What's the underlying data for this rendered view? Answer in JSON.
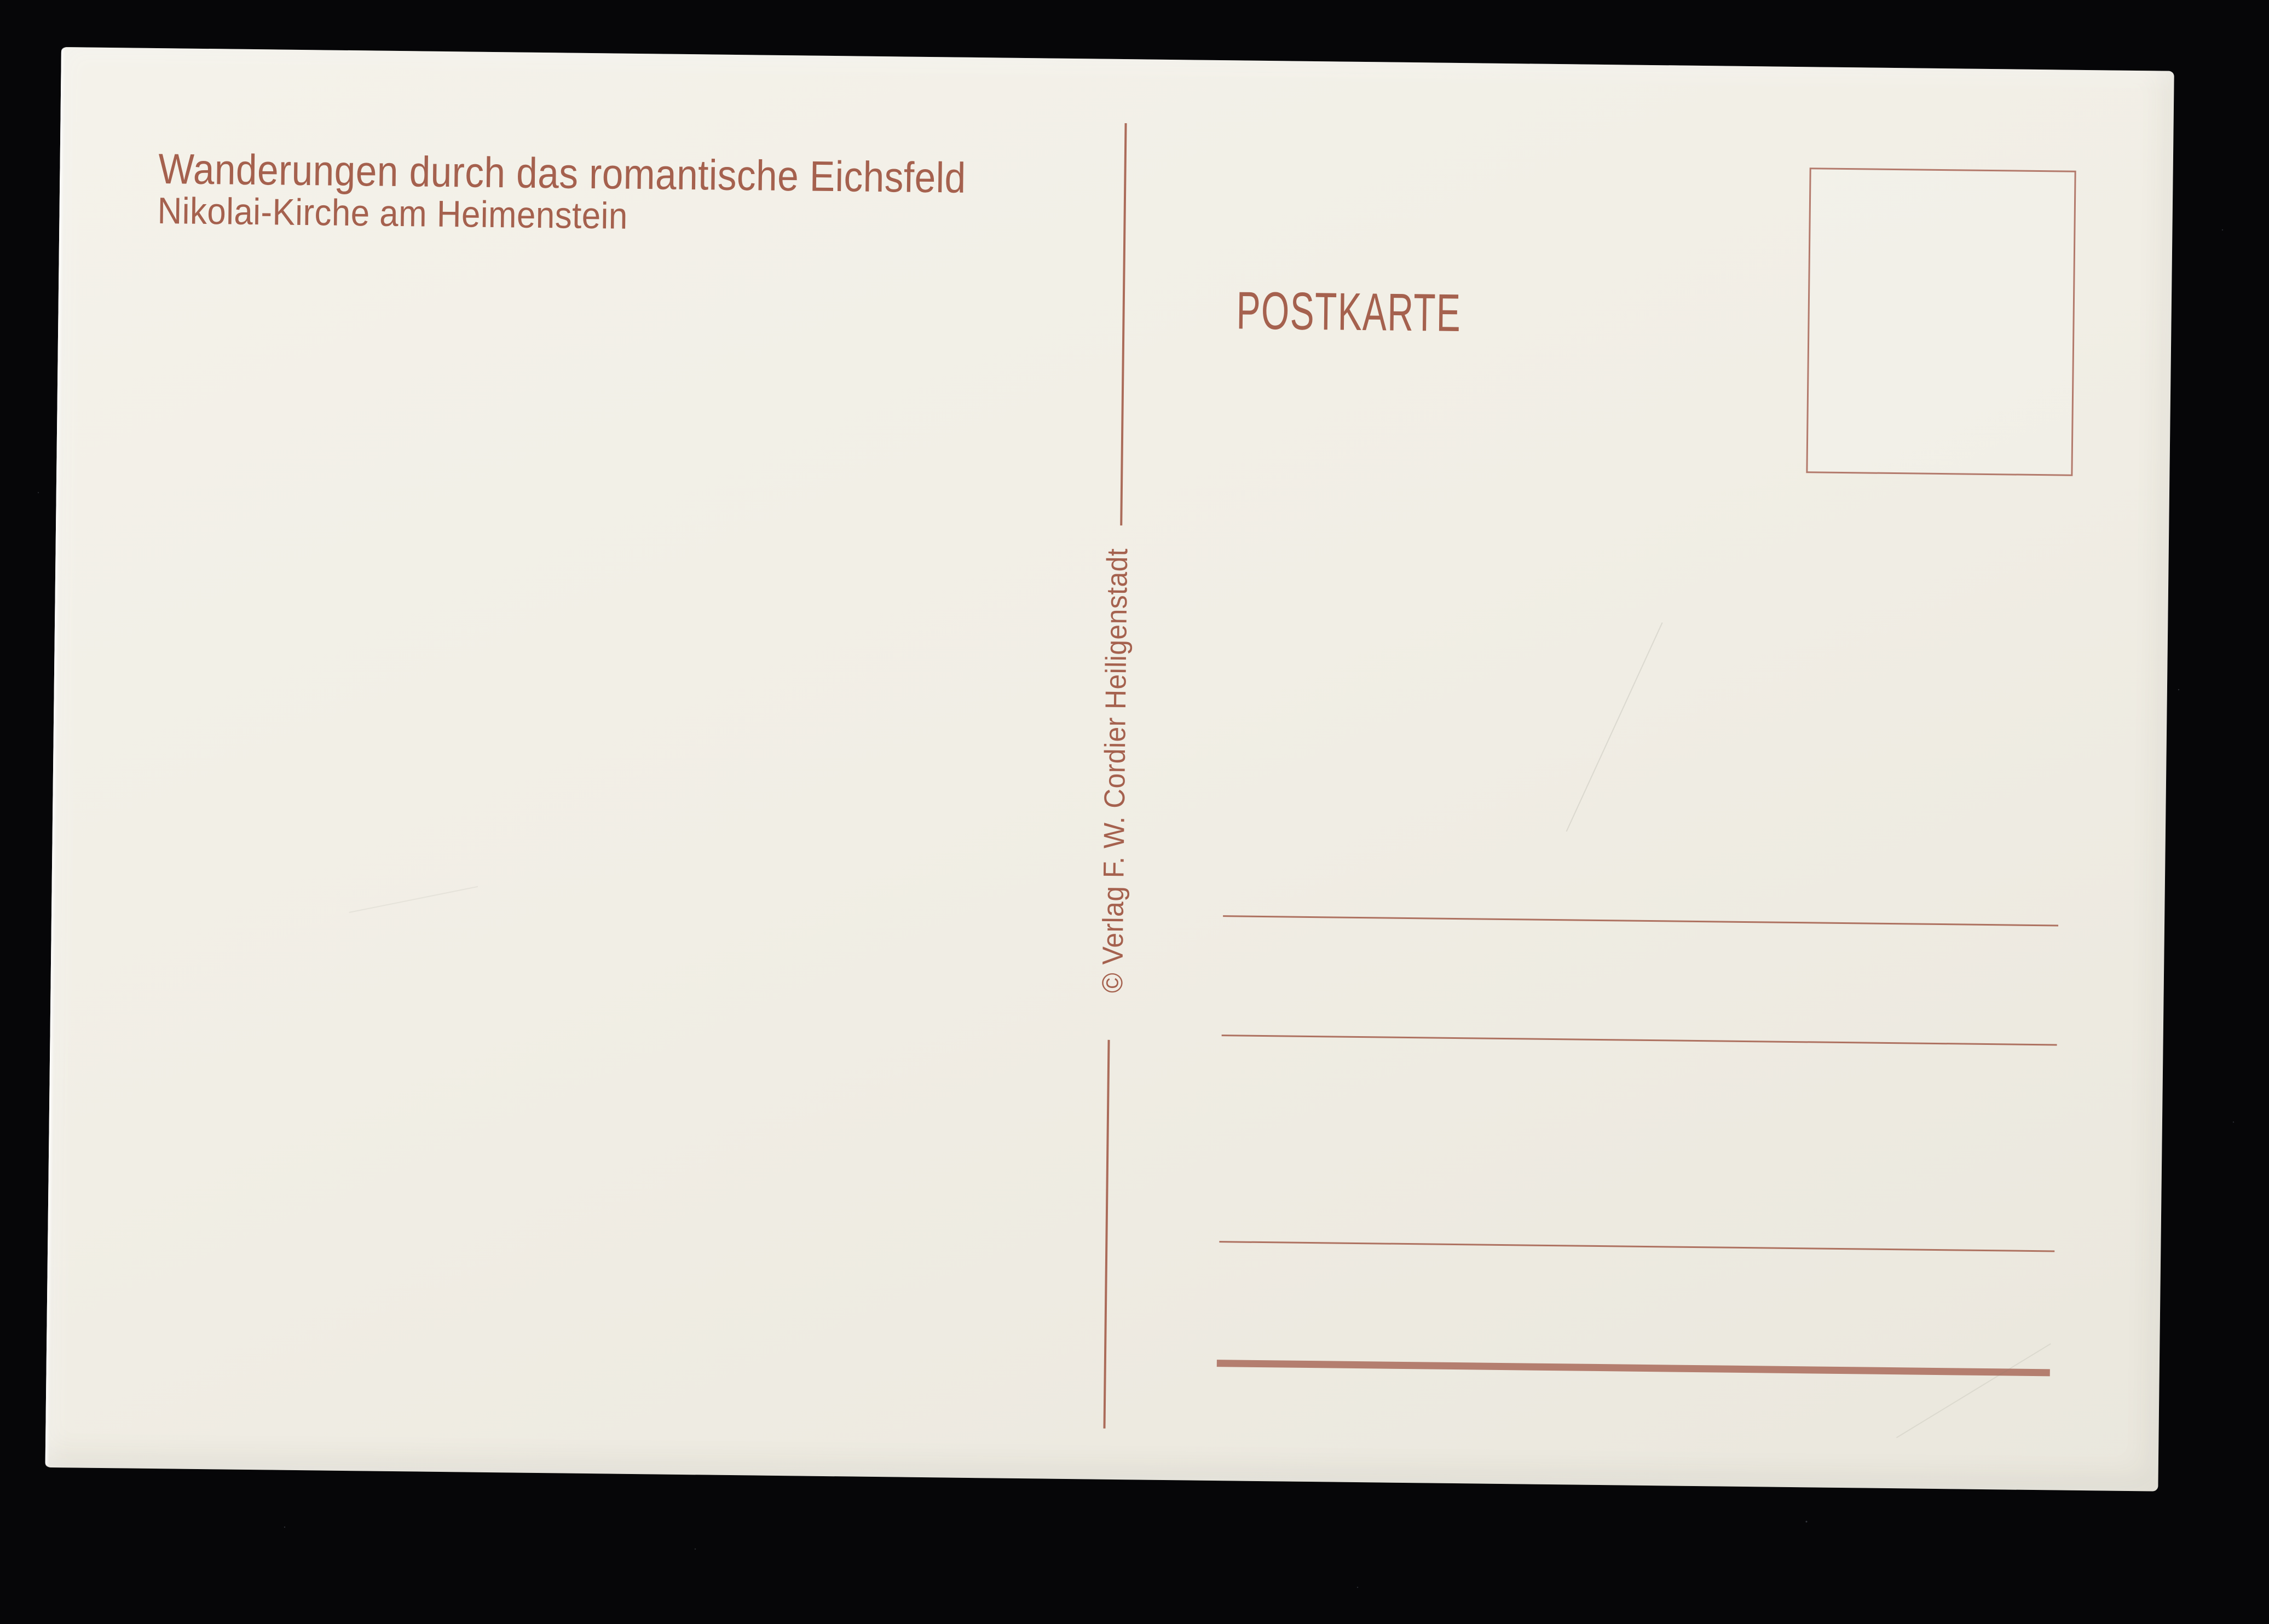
{
  "scene": {
    "background_color": "#060608",
    "paper_color": "#f1eee5",
    "ink_color": "#a5614e",
    "heavy_line_color": "#b17868"
  },
  "postcard": {
    "header": {
      "series_title": "Wanderungen durch das romantische Eichsfeld",
      "subtitle": "Nikolai-Kirche am Heimenstein"
    },
    "card_type_label": "POSTKARTE",
    "publisher_credit": "© Verlag F. W. Cordier Heiligenstadt",
    "address_lines": {
      "thin_line_count": 3,
      "heavy_line_count": 1
    }
  }
}
